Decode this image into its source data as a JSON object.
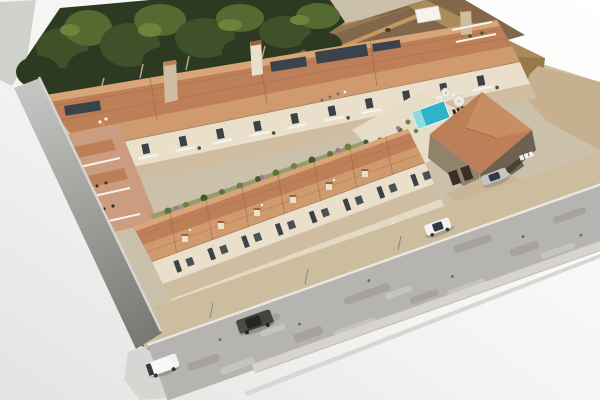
{
  "scene": {
    "type": "aerial-architectural-render",
    "description": "Aerial 3D render of a Mediterranean hillside residential development: a rear three-storey apartment row and a front terraced townhouse row with terracotta tiled roofs, a communal swimming pool with sun loungers and parasols, a stone clubhouse with garage doors, a dark tree line and dirt slope behind, gray and tan retaining walls, and a diagonal asphalt street with a white van, a dark SUV, a white car and a parked silver car on a plain white background.",
    "elements": {
      "tree_line": "dense evergreen canopy along the rear boundary",
      "hillside": "bare earth slope with rocks and a tan stone retaining wall",
      "back_building": "three-storey apartment row with balconies, roof terraces and solar panels",
      "front_building": "terraced townhouse row with private terraces and street hedge",
      "amenity": "pool deck with swimming pool, parasols, sun loungers",
      "clubhouse": "stone clubhouse with hipped tile roof and garage doors",
      "left_wall": "tall gray retaining wall at the west corner",
      "right_wall": "tan retaining wall and flat gravel terrace at the east side",
      "street": "wide asphalt road with patched surface, curbs and sidewalks"
    },
    "vehicles": [
      {
        "name": "white-van",
        "kind": "van",
        "color_ref": "car_white"
      },
      {
        "name": "dark-suv",
        "kind": "suv",
        "color_ref": "car_dark"
      },
      {
        "name": "white-car",
        "kind": "sedan",
        "color_ref": "car_white"
      },
      {
        "name": "silver-car",
        "kind": "sedan parked at clubhouse",
        "color_ref": "car_silver"
      }
    ],
    "counts": {
      "building_rows": 2,
      "townhouses": 8,
      "apartment_bays": 11,
      "pool_loungers": 7,
      "parasols": 3,
      "street_vehicles": 3,
      "parked_vehicles": 1
    }
  },
  "palette": {
    "bg_top": "#ffffff",
    "bg_bottom": "#e3e3e2",
    "terrain": "#d0d0cd",
    "site_base": "#cbc1aa",
    "tree_dark": "#2b3a21",
    "tree_mid": "#3e5128",
    "tree_light": "#556a30",
    "tree_pale": "#6e823c",
    "trunk": "#b4a78e",
    "dirt": "#82674a",
    "dirt_light": "#9d815a",
    "rock": "#483a27",
    "stone_wall": "#c49a62",
    "roof": "#bd7f57",
    "roof_light": "#cf9a6e",
    "roof_dark": "#9e5f3c",
    "roof_ridge": "#dcab7d",
    "wall_cream": "#eadfca",
    "wall_shadow": "#cfbda2",
    "wall_pink": "#cb9c80",
    "window": "#3a4147",
    "white_trim": "#f5f3ee",
    "solar": "#3a424b",
    "hedge": "#44582d",
    "shrub": "#5c7340",
    "olive": "#717d4b",
    "garden": "#979b70",
    "flower": "#ae6ba6",
    "flower_light": "#c791bb",
    "pool": "#2fb3c6",
    "pool_light": "#9fe2e7",
    "deck": "#e7ddc7",
    "lounger": "#2e2f2b",
    "club_stone": "#92826b",
    "club_stone_dark": "#6e6150",
    "garage": "#382f26",
    "tan_wall": "#aa8c5b",
    "tan_wall_dark": "#97794a",
    "tan_flat": "#c6b08f",
    "driveway": "#c9b697",
    "gray_wall_light": "#c5c5c3",
    "gray_wall_dark": "#767672",
    "road": "#b6b4b0",
    "road_dark": "#97948e",
    "road_light": "#cbc8c2",
    "sidewalk": "#cdbd9f",
    "curb": "#e9e7e1",
    "walk_lower": "#d7d4cd",
    "car_white": "#f2f2f0",
    "car_dark": "#41453b",
    "car_silver": "#c4c7ca",
    "glass": "#333940"
  }
}
